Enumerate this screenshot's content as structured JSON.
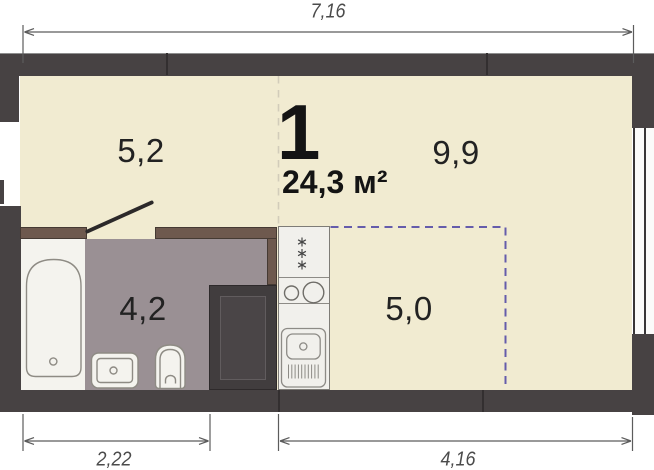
{
  "plan": {
    "unit_label": "1",
    "total_area": "24,3 м²",
    "zones": [
      {
        "name": "hallway",
        "area_label": "5,2"
      },
      {
        "name": "living-area",
        "area_label": "9,9"
      },
      {
        "name": "bathroom",
        "area_label": "4,2"
      },
      {
        "name": "kitchen-zone",
        "area_label": "5,0"
      }
    ],
    "dimensions": {
      "top_width": "7,16",
      "bottom_left_width": "2,22",
      "bottom_right_width": "4,16"
    },
    "colors": {
      "exterior_wall": "#474243",
      "floor": "#f1ebd1",
      "bathroom_floor": "#9a9094",
      "bathroom_wall": "#6e594e",
      "kitchen_zone_dash": "#655cab",
      "zone_divider_dash": "#d2ccba",
      "fixture_outline": "#8e8b84",
      "dimension_line": "#5c5c5c"
    },
    "icons": {
      "fridge": "triple-snowflake-icon",
      "cooktop": "two-burner-circles-icon",
      "kitchen_sink": "sink-with-drainboard-icon",
      "bathtub": "bathtub-outline-icon",
      "washbasin": "washbasin-outline-icon",
      "toilet": "toilet-outline-icon",
      "window": "double-pane-window-icon",
      "door": "door-swing-line-icon"
    }
  }
}
